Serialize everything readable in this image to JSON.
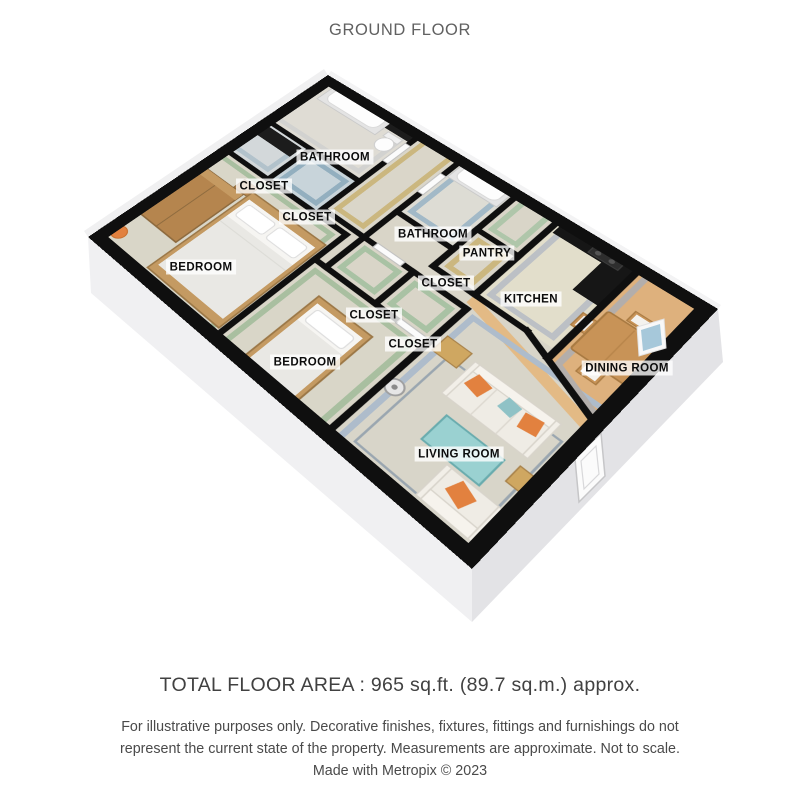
{
  "title": "GROUND FLOOR",
  "floor_plan": {
    "rooms": [
      {
        "id": "bathroom-1",
        "label": "BATHROOM",
        "x": 335,
        "y": 157
      },
      {
        "id": "closet-1",
        "label": "CLOSET",
        "x": 264,
        "y": 186
      },
      {
        "id": "closet-2",
        "label": "CLOSET",
        "x": 307,
        "y": 217
      },
      {
        "id": "bathroom-2",
        "label": "BATHROOM",
        "x": 433,
        "y": 234
      },
      {
        "id": "pantry",
        "label": "PANTRY",
        "x": 487,
        "y": 253
      },
      {
        "id": "bedroom-1",
        "label": "BEDROOM",
        "x": 201,
        "y": 267
      },
      {
        "id": "closet-3",
        "label": "CLOSET",
        "x": 446,
        "y": 283
      },
      {
        "id": "kitchen",
        "label": "KITCHEN",
        "x": 531,
        "y": 299
      },
      {
        "id": "closet-4",
        "label": "CLOSET",
        "x": 374,
        "y": 315
      },
      {
        "id": "closet-5",
        "label": "CLOSET",
        "x": 413,
        "y": 344
      },
      {
        "id": "bedroom-2",
        "label": "BEDROOM",
        "x": 305,
        "y": 362
      },
      {
        "id": "dining-room",
        "label": "DINING ROOM",
        "x": 627,
        "y": 368
      },
      {
        "id": "living-room",
        "label": "LIVING ROOM",
        "x": 459,
        "y": 454
      }
    ],
    "palette": {
      "wall_outline": "#0f0f0f",
      "carpet": "#d9d5c8",
      "wood_floor": "#deb17d",
      "green_wall": "#a9bfa0",
      "blue_wall": "#a2b9c7",
      "tan_wall": "#cbb77f",
      "gray_wall": "#bcc0c5",
      "living_wall": "#aebccb",
      "counter_black": "#161616",
      "accent_orange": "#e2813f",
      "accent_teal": "#8fc2c6",
      "base_gray": "#ededef",
      "label_bg": "rgba(255,255,255,0.78)",
      "label_text": "#0c0c0c",
      "title_text": "#616161",
      "footer_text": "#414141",
      "disclaimer_text": "#4a4a4a"
    }
  },
  "footer": {
    "total_area": "TOTAL FLOOR AREA : 965 sq.ft. (89.7 sq.m.) approx.",
    "disclaimer_line1": "For illustrative purposes only. Decorative finishes, fixtures, fittings and furnishings do not",
    "disclaimer_line2": "represent the current state of the property. Measurements are approximate. Not to scale.",
    "disclaimer_line3": "Made with Metropix © 2023"
  }
}
